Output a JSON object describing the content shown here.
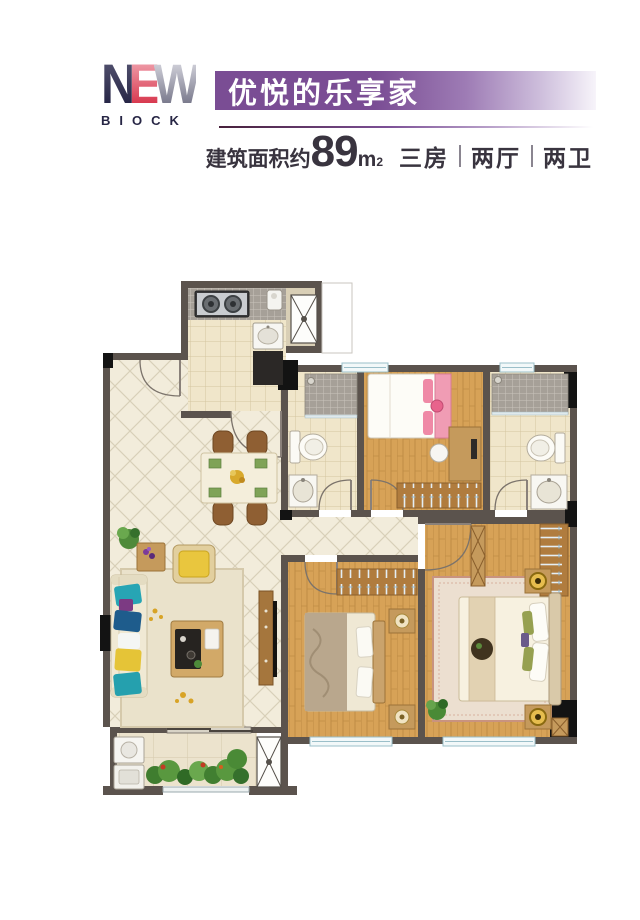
{
  "header": {
    "logo": {
      "n": "N",
      "e": "E",
      "w": "W",
      "sub": "BIOCK"
    },
    "banner": {
      "title": "优悦的乐享家"
    },
    "area": {
      "label": "建筑面积约",
      "value": "89",
      "unit": "m",
      "unit_exp": "2",
      "spec1": "三房",
      "spec2": "两厅",
      "spec3": "两卫"
    }
  },
  "colors": {
    "banner_purple": "#7a4d94",
    "logo_navy": "#272645",
    "logo_red": "#d42840",
    "text_dark": "#39343f",
    "wall": "#5b534d",
    "column_black": "#131313",
    "tile_cream": "#f2ecdb",
    "tile_bath": "#f0e6ca",
    "wood_floor": "#d7a257",
    "window_blue": "#9bbfc9",
    "plant_green": "#4a8a36"
  },
  "floorplan": {
    "rooms": [
      "foyer",
      "kitchen",
      "dining-room",
      "living-room",
      "balcony",
      "bathroom-1",
      "bedroom-2",
      "bathroom-2",
      "bedroom-3",
      "master-bedroom",
      "corridor"
    ]
  }
}
